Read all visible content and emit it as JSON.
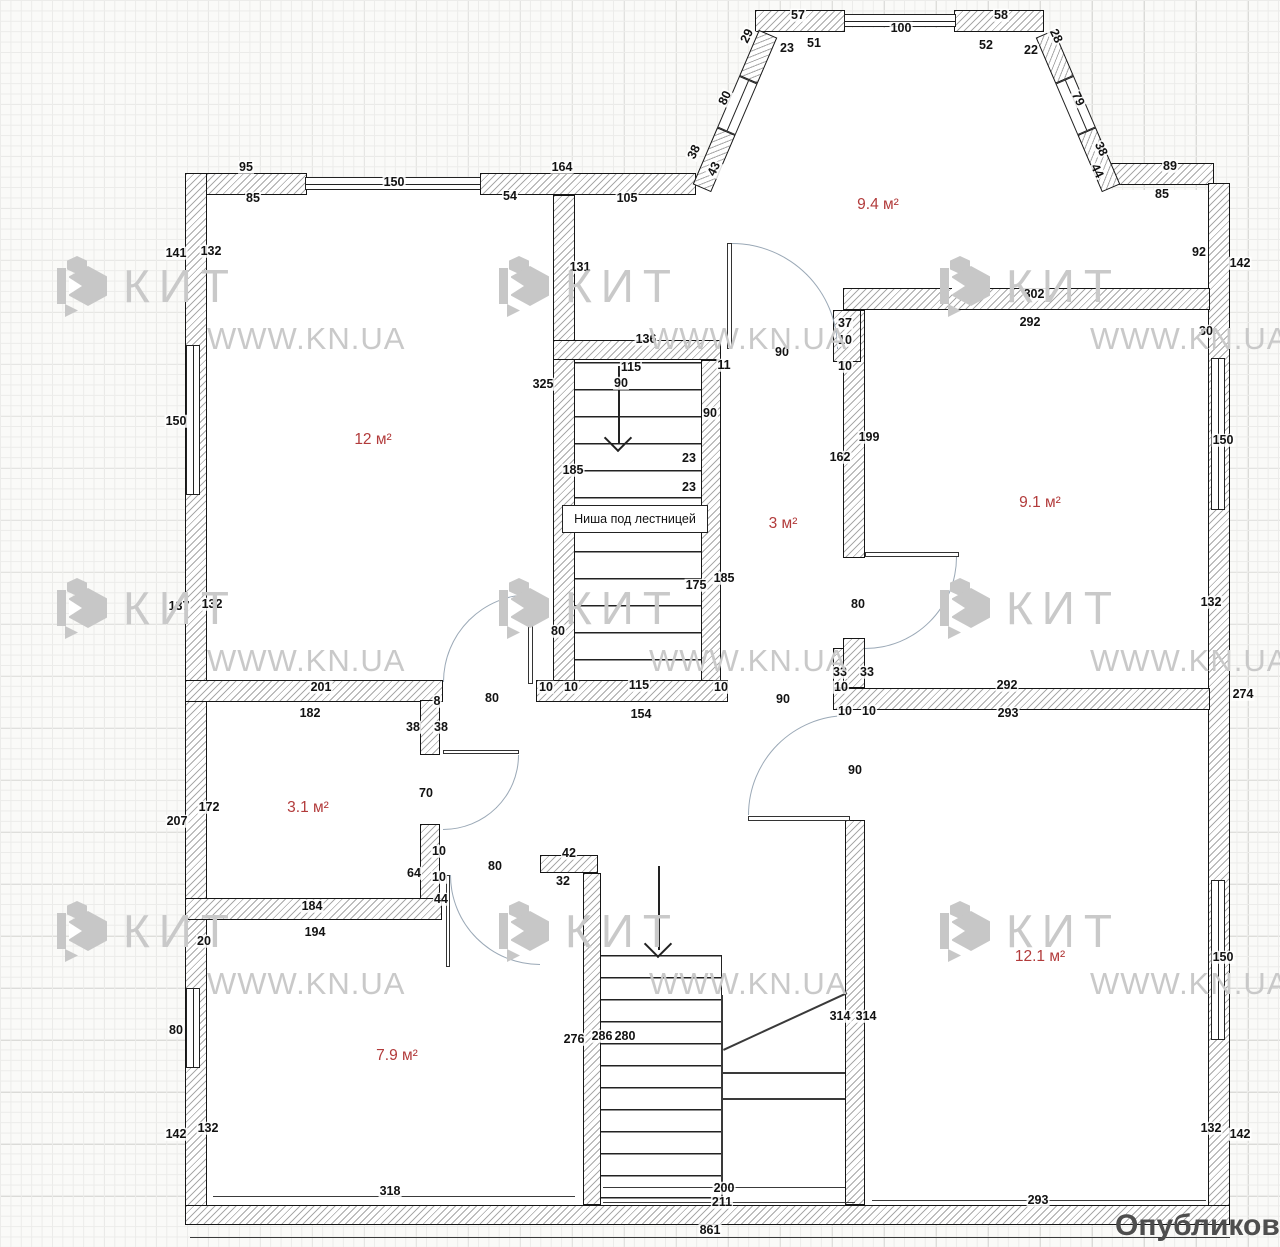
{
  "watermark": {
    "brand": "КИТ",
    "site": "WWW.KN.UA",
    "positions": [
      [
        55,
        255
      ],
      [
        497,
        255
      ],
      [
        938,
        255
      ],
      [
        55,
        577
      ],
      [
        497,
        577
      ],
      [
        938,
        577
      ],
      [
        55,
        900
      ],
      [
        497,
        900
      ],
      [
        938,
        900
      ]
    ]
  },
  "publish_label": "Опубликовать н",
  "niche_label": "Ниша под лестницей",
  "rooms": [
    {
      "label": "9.4 м²",
      "x": 878,
      "y": 205
    },
    {
      "label": "12 м²",
      "x": 373,
      "y": 440
    },
    {
      "label": "9.1 м²",
      "x": 1040,
      "y": 503
    },
    {
      "label": "3 м²",
      "x": 783,
      "y": 524
    },
    {
      "label": "3.1 м²",
      "x": 308,
      "y": 808
    },
    {
      "label": "7.9 м²",
      "x": 397,
      "y": 1056
    },
    {
      "label": "12.1 м²",
      "x": 1040,
      "y": 957
    }
  ],
  "dims": [
    {
      "t": "57",
      "x": 798,
      "y": 15
    },
    {
      "t": "29",
      "x": 747,
      "y": 36,
      "r": -64
    },
    {
      "t": "51",
      "x": 814,
      "y": 43
    },
    {
      "t": "23",
      "x": 787,
      "y": 48
    },
    {
      "t": "100",
      "x": 901,
      "y": 28
    },
    {
      "t": "58",
      "x": 1001,
      "y": 15
    },
    {
      "t": "52",
      "x": 986,
      "y": 45
    },
    {
      "t": "22",
      "x": 1031,
      "y": 50
    },
    {
      "t": "28",
      "x": 1056,
      "y": 36,
      "r": 64
    },
    {
      "t": "80",
      "x": 725,
      "y": 98,
      "r": -64
    },
    {
      "t": "79",
      "x": 1078,
      "y": 99,
      "r": 64
    },
    {
      "t": "38",
      "x": 694,
      "y": 152,
      "r": -64
    },
    {
      "t": "43",
      "x": 714,
      "y": 169,
      "r": -64
    },
    {
      "t": "38",
      "x": 1101,
      "y": 149,
      "r": 64
    },
    {
      "t": "44",
      "x": 1097,
      "y": 171,
      "r": 64
    },
    {
      "t": "95",
      "x": 246,
      "y": 167
    },
    {
      "t": "150",
      "x": 394,
      "y": 182
    },
    {
      "t": "85",
      "x": 253,
      "y": 198
    },
    {
      "t": "164",
      "x": 562,
      "y": 167
    },
    {
      "t": "54",
      "x": 510,
      "y": 196
    },
    {
      "t": "105",
      "x": 627,
      "y": 198
    },
    {
      "t": "141",
      "x": 176,
      "y": 253
    },
    {
      "t": "132",
      "x": 211,
      "y": 251
    },
    {
      "t": "150",
      "x": 176,
      "y": 421
    },
    {
      "t": "131",
      "x": 580,
      "y": 267
    },
    {
      "t": "325",
      "x": 543,
      "y": 384
    },
    {
      "t": "137",
      "x": 179,
      "y": 606
    },
    {
      "t": "132",
      "x": 212,
      "y": 604
    },
    {
      "t": "89",
      "x": 1170,
      "y": 166
    },
    {
      "t": "85",
      "x": 1162,
      "y": 194
    },
    {
      "t": "92",
      "x": 1199,
      "y": 252
    },
    {
      "t": "142",
      "x": 1240,
      "y": 263
    },
    {
      "t": "302",
      "x": 1034,
      "y": 294
    },
    {
      "t": "292",
      "x": 1030,
      "y": 322
    },
    {
      "t": "30",
      "x": 1206,
      "y": 331
    },
    {
      "t": "150",
      "x": 1223,
      "y": 440
    },
    {
      "t": "132",
      "x": 1211,
      "y": 602
    },
    {
      "t": "274",
      "x": 1243,
      "y": 694
    },
    {
      "t": "136",
      "x": 646,
      "y": 339
    },
    {
      "t": "115",
      "x": 631,
      "y": 367
    },
    {
      "t": "90",
      "x": 621,
      "y": 383
    },
    {
      "t": "11",
      "x": 724,
      "y": 365
    },
    {
      "t": "90",
      "x": 782,
      "y": 352
    },
    {
      "t": "37",
      "x": 845,
      "y": 323
    },
    {
      "t": "10",
      "x": 845,
      "y": 340
    },
    {
      "t": "10",
      "x": 845,
      "y": 366
    },
    {
      "t": "90",
      "x": 710,
      "y": 413
    },
    {
      "t": "162",
      "x": 840,
      "y": 457
    },
    {
      "t": "199",
      "x": 869,
      "y": 437
    },
    {
      "t": "23",
      "x": 689,
      "y": 458
    },
    {
      "t": "23",
      "x": 689,
      "y": 487
    },
    {
      "t": "185",
      "x": 573,
      "y": 470
    },
    {
      "t": "175",
      "x": 696,
      "y": 585
    },
    {
      "t": "185",
      "x": 724,
      "y": 578
    },
    {
      "t": "80",
      "x": 558,
      "y": 631
    },
    {
      "t": "80",
      "x": 858,
      "y": 604
    },
    {
      "t": "33",
      "x": 840,
      "y": 672
    },
    {
      "t": "33",
      "x": 867,
      "y": 672
    },
    {
      "t": "10",
      "x": 841,
      "y": 687
    },
    {
      "t": "10",
      "x": 845,
      "y": 711
    },
    {
      "t": "10",
      "x": 869,
      "y": 711
    },
    {
      "t": "90",
      "x": 855,
      "y": 770
    },
    {
      "t": "201",
      "x": 321,
      "y": 687
    },
    {
      "t": "182",
      "x": 310,
      "y": 713
    },
    {
      "t": "80",
      "x": 492,
      "y": 698
    },
    {
      "t": "10",
      "x": 546,
      "y": 687
    },
    {
      "t": "10",
      "x": 571,
      "y": 687
    },
    {
      "t": "115",
      "x": 639,
      "y": 685
    },
    {
      "t": "10",
      "x": 721,
      "y": 687
    },
    {
      "t": "154",
      "x": 641,
      "y": 714
    },
    {
      "t": "90",
      "x": 783,
      "y": 699
    },
    {
      "t": "8",
      "x": 437,
      "y": 701
    },
    {
      "t": "38",
      "x": 413,
      "y": 727
    },
    {
      "t": "38",
      "x": 441,
      "y": 727
    },
    {
      "t": "292",
      "x": 1007,
      "y": 685
    },
    {
      "t": "293",
      "x": 1008,
      "y": 713
    },
    {
      "t": "207",
      "x": 177,
      "y": 821
    },
    {
      "t": "172",
      "x": 209,
      "y": 807
    },
    {
      "t": "70",
      "x": 426,
      "y": 793
    },
    {
      "t": "64",
      "x": 414,
      "y": 873
    },
    {
      "t": "10",
      "x": 439,
      "y": 851
    },
    {
      "t": "10",
      "x": 439,
      "y": 877
    },
    {
      "t": "44",
      "x": 441,
      "y": 899
    },
    {
      "t": "184",
      "x": 312,
      "y": 906
    },
    {
      "t": "194",
      "x": 315,
      "y": 932
    },
    {
      "t": "20",
      "x": 204,
      "y": 941
    },
    {
      "t": "80",
      "x": 495,
      "y": 866
    },
    {
      "t": "42",
      "x": 569,
      "y": 853
    },
    {
      "t": "32",
      "x": 563,
      "y": 881
    },
    {
      "t": "80",
      "x": 176,
      "y": 1030
    },
    {
      "t": "142",
      "x": 176,
      "y": 1134
    },
    {
      "t": "132",
      "x": 208,
      "y": 1128
    },
    {
      "t": "276",
      "x": 574,
      "y": 1039
    },
    {
      "t": "286",
      "x": 602,
      "y": 1036
    },
    {
      "t": "280",
      "x": 625,
      "y": 1036
    },
    {
      "t": "314",
      "x": 840,
      "y": 1016
    },
    {
      "t": "314",
      "x": 866,
      "y": 1016
    },
    {
      "t": "150",
      "x": 1223,
      "y": 957
    },
    {
      "t": "132",
      "x": 1211,
      "y": 1128
    },
    {
      "t": "142",
      "x": 1240,
      "y": 1134
    },
    {
      "t": "318",
      "x": 390,
      "y": 1191
    },
    {
      "t": "200",
      "x": 724,
      "y": 1188
    },
    {
      "t": "211",
      "x": 722,
      "y": 1202
    },
    {
      "t": "293",
      "x": 1038,
      "y": 1200
    },
    {
      "t": "861",
      "x": 710,
      "y": 1230
    }
  ]
}
